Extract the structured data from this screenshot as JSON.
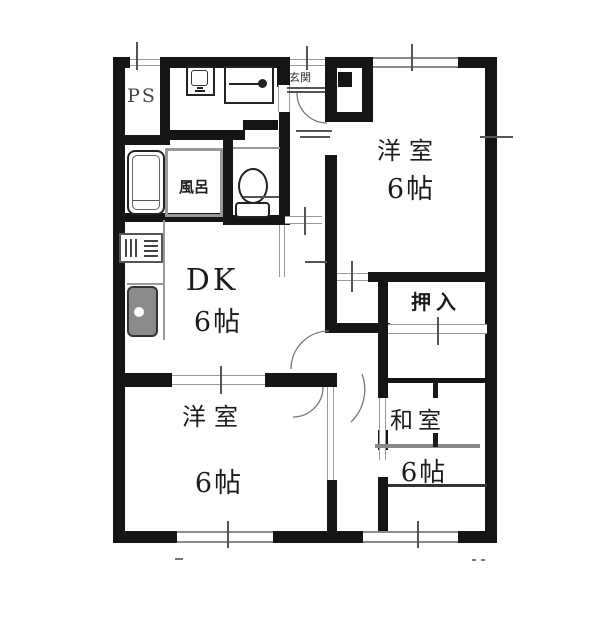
{
  "floorplan": {
    "type": "japanese-apartment-floor-plan",
    "rooms": {
      "ps": {
        "label": "PS"
      },
      "entrance": {
        "label": "玄関"
      },
      "bath": {
        "label": "風呂"
      },
      "dk": {
        "label": "DK",
        "size": "6帖"
      },
      "western_top": {
        "label": "洋室",
        "size": "6帖"
      },
      "western_bottom": {
        "label": "洋室",
        "size": "6帖"
      },
      "japanese": {
        "label": "和室",
        "size": "6帖"
      },
      "closet": {
        "label": "押入"
      }
    },
    "fixtures": [
      "bathtub",
      "washing-machine",
      "vanity-basin",
      "toilet",
      "gas-stove",
      "kitchen-sink",
      "shoe-cabinet"
    ],
    "colors": {
      "wall": "#151515",
      "gray-line": "#999999",
      "sink-fill": "#8a8a8a",
      "background": "#ffffff"
    }
  }
}
